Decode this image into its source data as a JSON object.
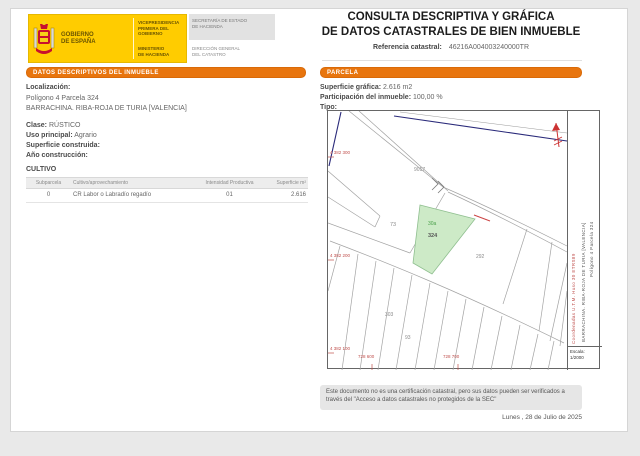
{
  "logo": {
    "gobierno_l1": "GOBIERNO",
    "gobierno_l2": "DE ESPAÑA",
    "vice_l1": "VICEPRESIDENCIA",
    "vice_l2": "PRIMERA DEL GOBIERNO",
    "min_l1": "MINISTERIO",
    "min_l2": "DE HACIENDA",
    "sec_l1": "SECRETARÍA DE ESTADO",
    "sec_l2": "DE HACIENDA",
    "dir_l1": "DIRECCIÓN GENERAL",
    "dir_l2": "DEL CATASTRO"
  },
  "header": {
    "title_line1": "CONSULTA DESCRIPTIVA Y GRÁFICA",
    "title_line2": "DE DATOS CATASTRALES DE BIEN INMUEBLE",
    "ref_label": "Referencia catastral:",
    "ref_value": "46216A004003240000TR"
  },
  "left": {
    "section_header": "DATOS DESCRIPTIVOS DEL INMUEBLE",
    "localizacion_label": "Localización:",
    "localizacion_line1": "Polígono 4 Parcela 324",
    "localizacion_line2": "BARRACHINA. RIBA-ROJA DE TURIA [VALENCIA]",
    "clase_label": "Clase:",
    "clase_value": "RÚSTICO",
    "uso_label": "Uso principal:",
    "uso_value": "Agrario",
    "superficie_label": "Superficie construida:",
    "superficie_value": "",
    "ano_label": "Año construcción:",
    "ano_value": "",
    "cultivo_title": "CULTIVO",
    "table": {
      "headers": [
        "Subparcela",
        "Cultivo/aprovechamiento",
        "Intensidad Productiva",
        "Superficie m²"
      ],
      "rows": [
        [
          "0",
          "CR Labor o Labradío regadío",
          "01",
          "2.616"
        ]
      ]
    }
  },
  "right": {
    "section_header": "PARCELA",
    "superficie_label": "Superficie gráfica:",
    "superficie_value": "2.616 m2",
    "participacion_label": "Participación del inmueble:",
    "participacion_value": "100,00 %",
    "tipo_label": "Tipo:",
    "tipo_value": ""
  },
  "map": {
    "side_text_line1": "Polígono 4 Parcela 324",
    "side_text_line2": "BARRACHINA. RIBA-ROJA DE TURIA [VALENCIA]",
    "side_text_red": "Coordenadas U.T.M. Huso 30 ETRS89",
    "escala_label": "Escala:",
    "escala_value": "1/2000",
    "coords_left": [
      "4 382 300",
      "4 382 200",
      "4 382 100"
    ],
    "coords_bottom": [
      "728 600",
      "728 700"
    ],
    "labels": {
      "road": "9017",
      "p73": "73",
      "sub": "30a",
      "main": "324",
      "p292": "292",
      "p303": "303",
      "p93": "93"
    },
    "colors": {
      "accent_orange": "#e8750e",
      "logo_yellow": "#ffcc00",
      "parcel_highlight": "#cdeac7",
      "map_red": "#c0504d",
      "navy": "#2a2a7a"
    }
  },
  "footer": {
    "disclaimer": "Este documento no es una certificación catastral, pero sus datos pueden ser verificados a través del \"Acceso a datos catastrales no protegidos de la SEC\"",
    "date": "Lunes , 28 de Julio de 2025"
  }
}
